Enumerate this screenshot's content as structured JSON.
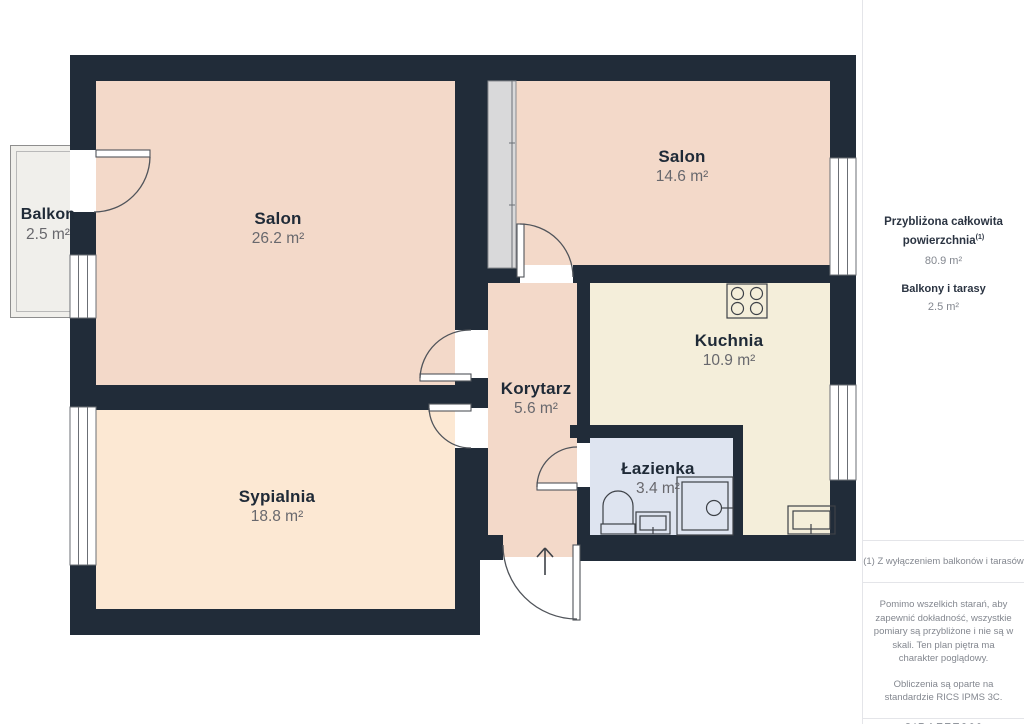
{
  "plan": {
    "rooms": {
      "salon_large": {
        "name": "Salon",
        "area": "26.2 m²"
      },
      "sypialnia": {
        "name": "Sypialnia",
        "area": "18.8 m²"
      },
      "salon_small": {
        "name": "Salon",
        "area": "14.6 m²"
      },
      "kuchnia": {
        "name": "Kuchnia",
        "area": "10.9 m²"
      },
      "korytarz": {
        "name": "Korytarz",
        "area": "5.6 m²"
      },
      "lazienka": {
        "name": "Łazienka",
        "area": "3.4 m²"
      },
      "balkon": {
        "name": "Balkon",
        "area": "2.5 m²"
      }
    },
    "colors": {
      "walls": "#212c39",
      "salon": "#f3d9c9",
      "sypialnia_fill": "#fce8d3",
      "kuchnia_fill": "#f4eeda",
      "lazienka_fill": "#dee4f0",
      "balkon_fill": "#f0efeb",
      "wardrobe": "#d9d9da",
      "label_name": "#1f2a37",
      "label_area": "#68686d",
      "sidebar_heading": "#2b3442",
      "sidebar_text": "#83878f",
      "divider": "#e4e5e9"
    }
  },
  "sidebar": {
    "total_label_line1": "Przybliżona całkowita",
    "total_label_line2": "powierzchnia",
    "total_footnote_marker": "(1)",
    "total_value": "80.9 m²",
    "balconies_label": "Balkony i tarasy",
    "balconies_value": "2.5 m²",
    "footnote": "(1) Z wyłączeniem balkonów i tarasów",
    "disclaimer1": "Pomimo wszelkich starań, aby zapewnić dokładność, wszystkie pomiary są przybliżone i nie są w skali. Ten plan piętra ma charakter poglądowy.",
    "disclaimer2": "Obliczenia są oparte na standardzie RICS IPMS 3C.",
    "brand_name": "GIRAFFE",
    "brand_suffix": "360"
  }
}
